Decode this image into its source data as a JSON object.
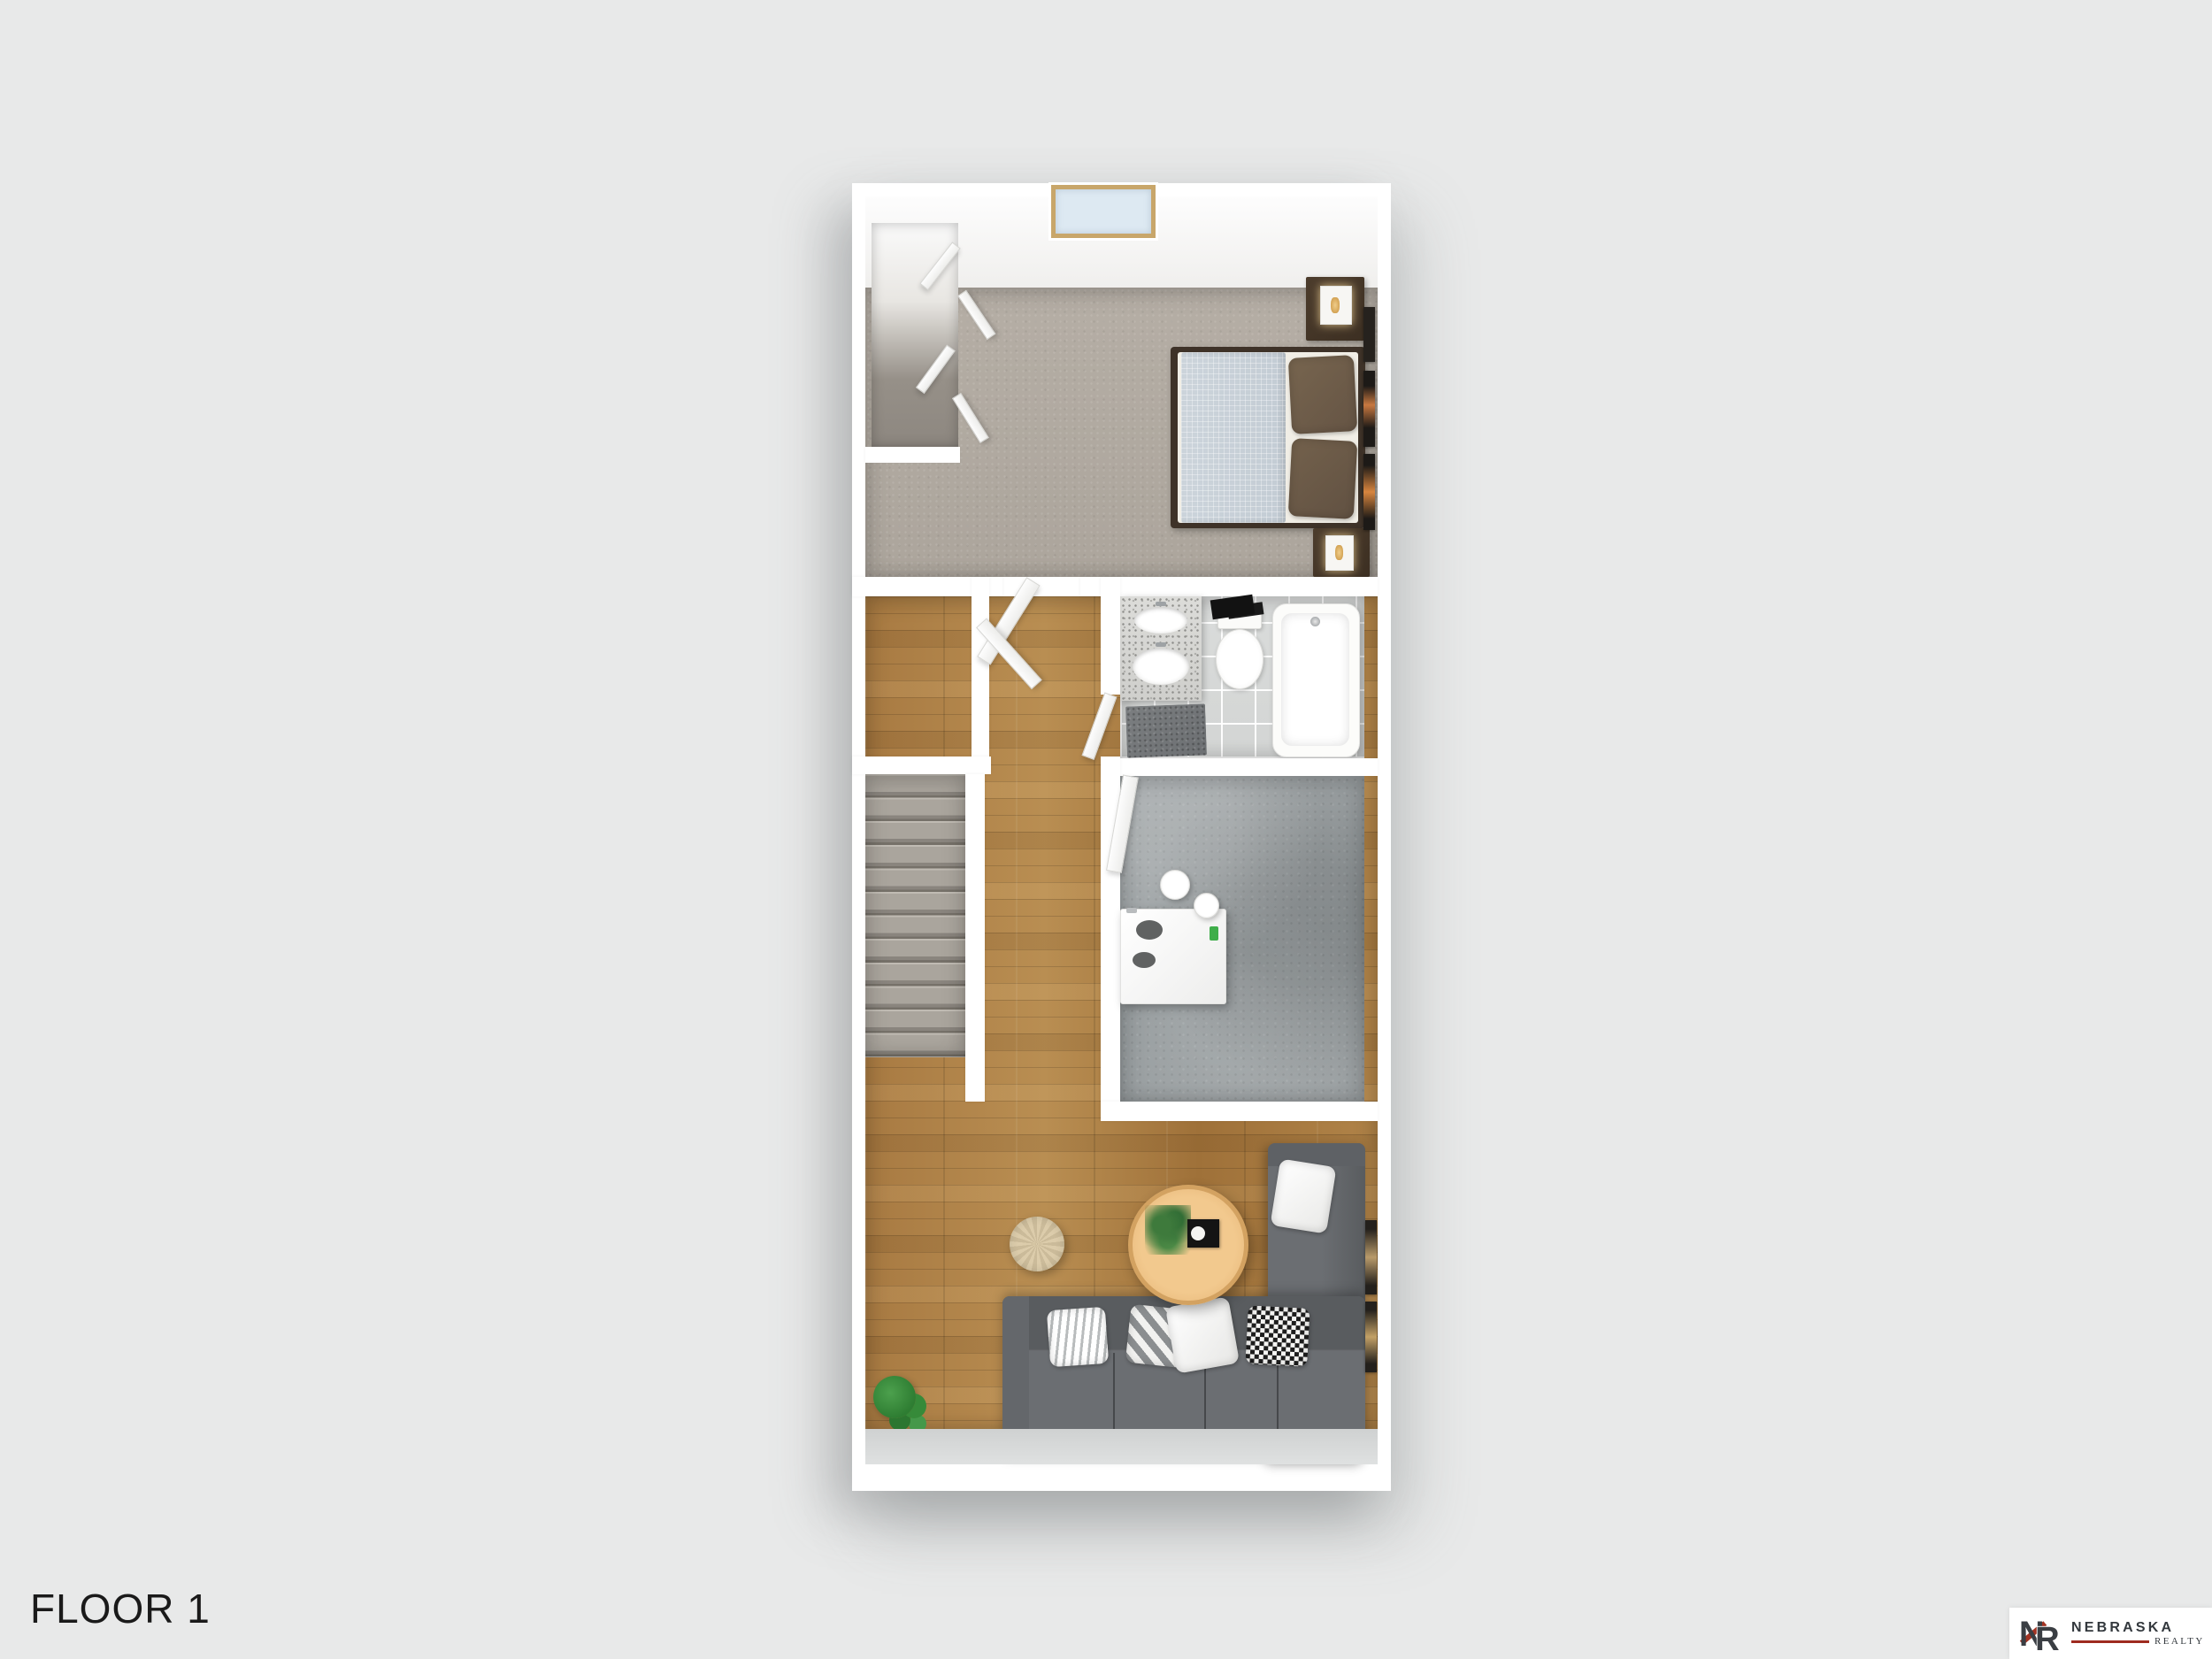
{
  "floor_label": "FLOOR 1",
  "logo": {
    "monogram_n": "N",
    "monogram_r": "R",
    "name": "NEBRASKA",
    "subtitle": "REALTY"
  },
  "colors": {
    "background": "#e8e9e9",
    "wall": "#ffffff",
    "carpet": "#b1aaa2",
    "wood": "#a97c44",
    "concrete": "#9ca1a3",
    "tile": "#d8dad9",
    "sofa": "#64676b",
    "coffee_table": "#eec185",
    "accent_red": "#9e2b20",
    "logo_text": "#33383d",
    "label": "#1a1a1a"
  },
  "plan": {
    "rooms": [
      "bedroom",
      "closet",
      "hallway",
      "bathroom",
      "kitchen-dining",
      "stairs",
      "living-room"
    ],
    "furniture_icons": [
      "window",
      "bifold-closet-doors",
      "bed",
      "nightstand",
      "lamp",
      "wall-frames",
      "vanity-sink",
      "toilet",
      "bathtub",
      "bath-rug",
      "interior-doors",
      "kitchen-island",
      "bar-stools",
      "staircase",
      "sectional-sofa",
      "throw-pillows",
      "coffee-table",
      "pouf",
      "potted-plant"
    ]
  }
}
